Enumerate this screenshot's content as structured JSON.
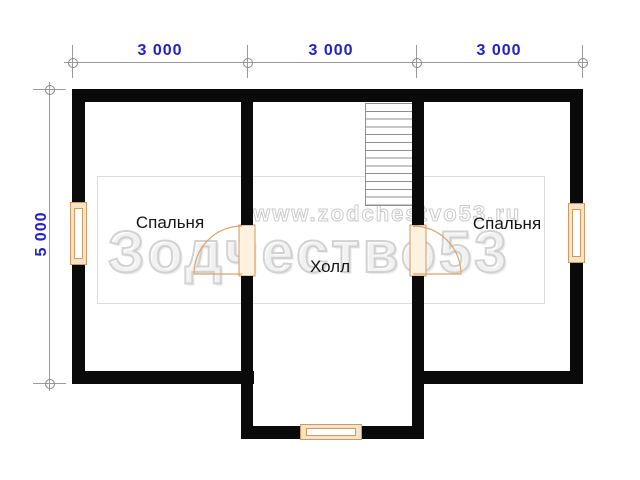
{
  "plan": {
    "title": "floor-plan-second-level",
    "rooms": [
      {
        "id": "bedroom-left",
        "label": "Спальня"
      },
      {
        "id": "hall",
        "label": "Холл"
      },
      {
        "id": "bedroom-right",
        "label": "Спальня"
      }
    ],
    "dimensions": {
      "top": [
        "3 000",
        "3 000",
        "3 000"
      ],
      "left": "5 000"
    },
    "features": [
      "staircase",
      "window-left",
      "window-right",
      "window-bottom",
      "door-left-bedroom",
      "door-right-bedroom"
    ],
    "watermark": {
      "large": "Зодчество53",
      "url": "www.zodchestvo53.ru"
    }
  },
  "colors": {
    "wall": "#0a0a0a",
    "dimension_text": "#2121c4",
    "dimension_line": "#9a9a9a",
    "window_frame": "#cf9a62",
    "window_fill": "#f6e2c6",
    "door": "#dfa268",
    "door_fill": "#fdf1e0",
    "stair_line": "#8f8f8f",
    "watermark": "#cdcdcd"
  }
}
